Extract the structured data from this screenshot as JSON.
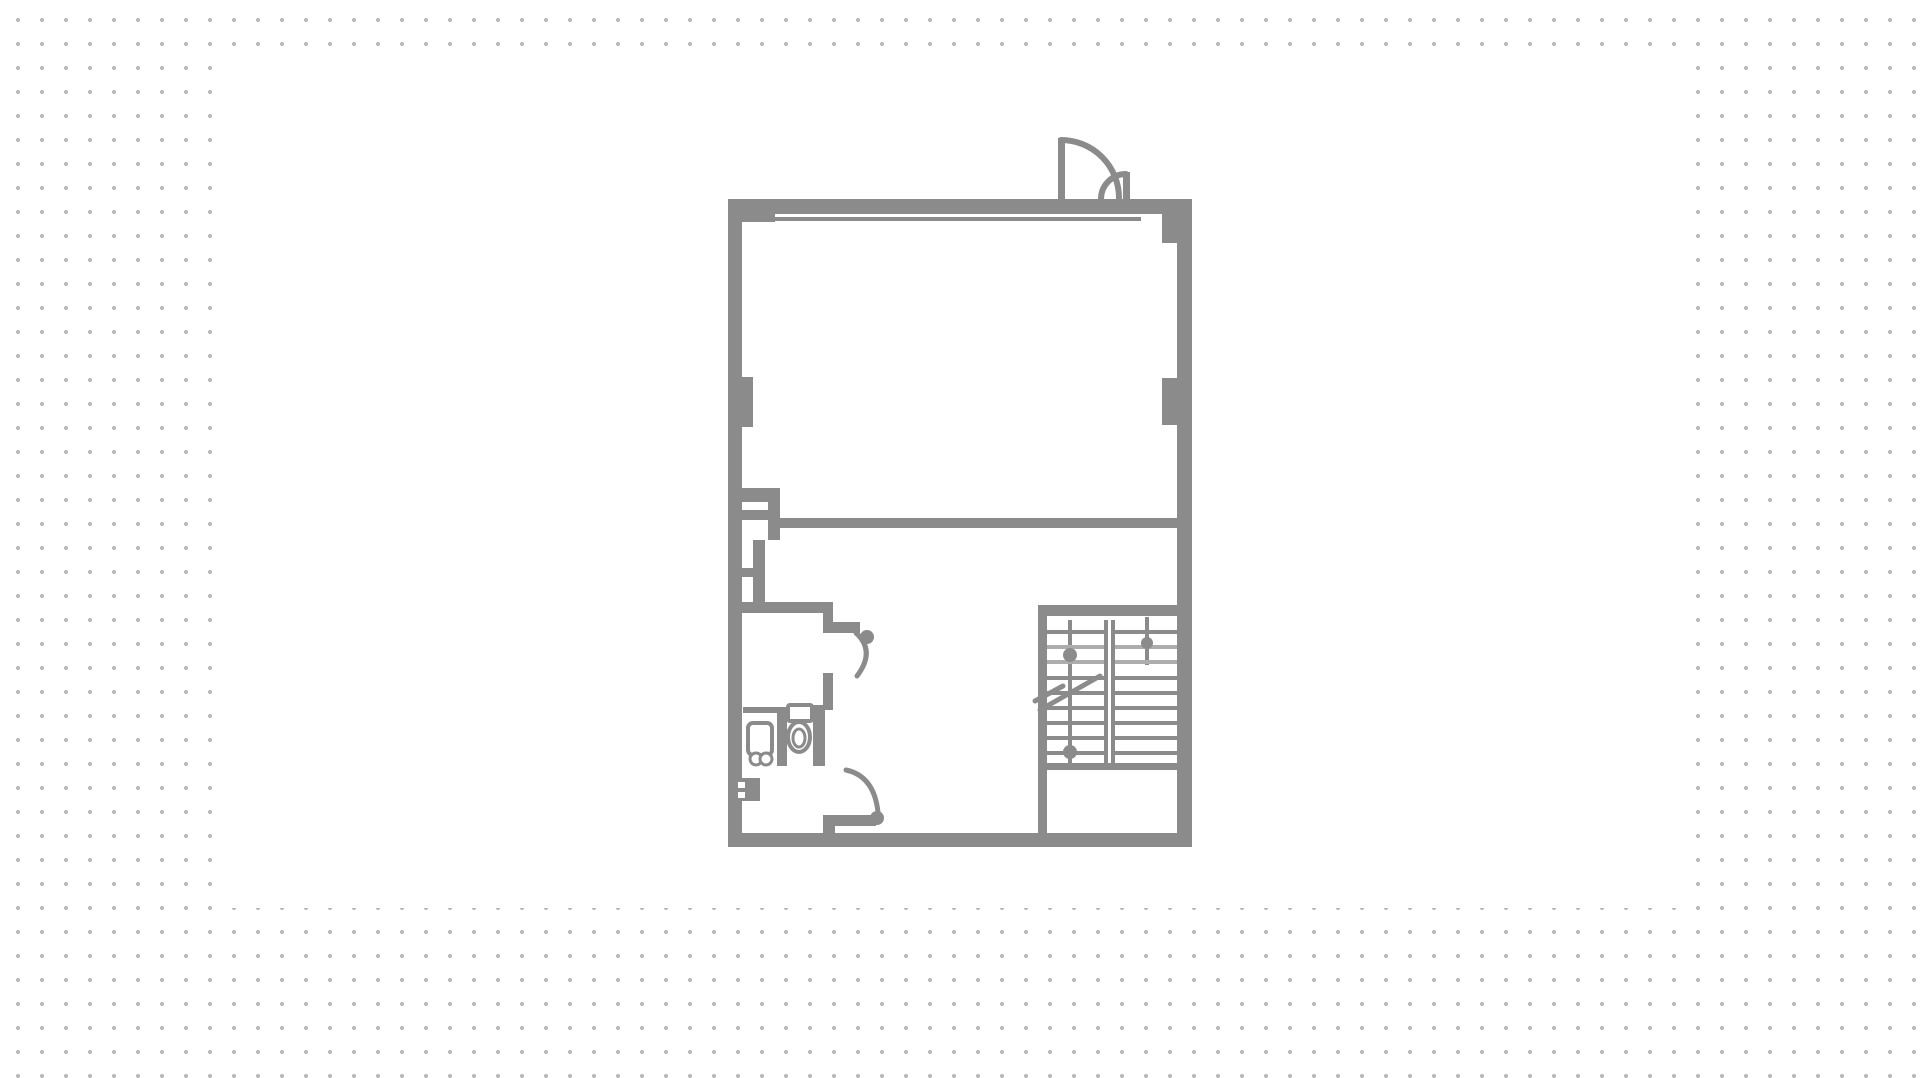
{
  "meta": {
    "type": "architectural-floor-plan",
    "description": "Gray line-drawing floor plan centered on a white panel over a dotted-grid background. Upper large empty room with storefront window wall and double entry door at top right; middle partition wall; lower zone with bathroom (washbasin and toilet), service ducts and shaft at left, two interior swing doors, and a double-flight staircase with direction arrows and break line at lower right.",
    "colors": {
      "background": "#ffffff",
      "grid_dot": "#b9b9b9",
      "wall": "#8b8b8b",
      "tread_light": "#adadad",
      "canvas": "#ffffff"
    }
  },
  "plan": {
    "canvas": {
      "x": 228,
      "y": 60,
      "w": 1462,
      "h": 848
    },
    "rects": [
      {
        "name": "wall-left",
        "x": 728,
        "y": 199,
        "w": 14,
        "h": 648
      },
      {
        "name": "wall-top",
        "x": 728,
        "y": 199,
        "w": 464,
        "h": 15
      },
      {
        "name": "wall-right",
        "x": 1177,
        "y": 199,
        "w": 15,
        "h": 648
      },
      {
        "name": "wall-right-head",
        "x": 1162,
        "y": 199,
        "w": 30,
        "h": 44
      },
      {
        "name": "wall-bottom",
        "x": 728,
        "y": 833,
        "w": 464,
        "h": 14
      },
      {
        "name": "window-end-block",
        "x": 742,
        "y": 213,
        "w": 33,
        "h": 9
      },
      {
        "name": "window-glazing-line",
        "x": 775,
        "y": 217,
        "w": 366,
        "h": 4
      },
      {
        "name": "pilaster-left",
        "x": 742,
        "y": 377,
        "w": 11,
        "h": 50
      },
      {
        "name": "pilaster-right",
        "x": 1162,
        "y": 378,
        "w": 15,
        "h": 47
      },
      {
        "name": "partition-mid-wall",
        "x": 780,
        "y": 518,
        "w": 397,
        "h": 10
      },
      {
        "name": "closet-branch-wall",
        "x": 742,
        "y": 488,
        "w": 38,
        "h": 14
      },
      {
        "name": "closet-right-wall",
        "x": 768,
        "y": 488,
        "w": 12,
        "h": 52
      },
      {
        "name": "closet-divider",
        "x": 742,
        "y": 510,
        "w": 26,
        "h": 10
      },
      {
        "name": "duct-wall",
        "x": 753,
        "y": 540,
        "w": 12,
        "h": 63
      },
      {
        "name": "duct-divider",
        "x": 742,
        "y": 568,
        "w": 23,
        "h": 9
      },
      {
        "name": "bathroom-top-wall",
        "x": 742,
        "y": 602,
        "w": 91,
        "h": 11
      },
      {
        "name": "upper-door-jamb",
        "x": 823,
        "y": 613,
        "w": 10,
        "h": 20
      },
      {
        "name": "upper-door-leaf",
        "x": 833,
        "y": 622,
        "w": 27,
        "h": 11
      },
      {
        "name": "wall-stub",
        "x": 823,
        "y": 673,
        "w": 10,
        "h": 37
      },
      {
        "name": "bath-cell-top-left",
        "x": 743,
        "y": 707,
        "w": 34,
        "h": 6
      },
      {
        "name": "bath-cell-top-right",
        "x": 787,
        "y": 707,
        "w": 26,
        "h": 6
      },
      {
        "name": "bath-divider-wall",
        "x": 777,
        "y": 707,
        "w": 10,
        "h": 59
      },
      {
        "name": "bath-right-wall",
        "x": 813,
        "y": 705,
        "w": 12,
        "h": 61
      },
      {
        "name": "shaft-box",
        "x": 738,
        "y": 778,
        "w": 22,
        "h": 23
      },
      {
        "name": "shaft-notch",
        "x": 738,
        "y": 782,
        "w": 7,
        "h": 6,
        "fill": "#ffffff"
      },
      {
        "name": "shaft-notch",
        "x": 738,
        "y": 792,
        "w": 7,
        "h": 6,
        "fill": "#ffffff"
      },
      {
        "name": "lower-door-jamb",
        "x": 823,
        "y": 815,
        "w": 12,
        "h": 18
      },
      {
        "name": "lower-door-leaf",
        "x": 828,
        "y": 815,
        "w": 48,
        "h": 11
      },
      {
        "name": "stair-left-wall",
        "x": 1038,
        "y": 605,
        "w": 9,
        "h": 228
      },
      {
        "name": "stair-top-edge",
        "x": 1038,
        "y": 605,
        "w": 139,
        "h": 11
      },
      {
        "name": "stair-bottom-edge",
        "x": 1047,
        "y": 763,
        "w": 130,
        "h": 7
      },
      {
        "name": "stair-center-divider",
        "x": 1104,
        "y": 620,
        "w": 4,
        "h": 150
      },
      {
        "name": "stair-center-divider",
        "x": 1111,
        "y": 620,
        "w": 4,
        "h": 150
      },
      {
        "name": "stair-direction-line",
        "x": 1068,
        "y": 620,
        "w": 4,
        "h": 145
      },
      {
        "name": "stair-direction-line",
        "x": 1145,
        "y": 617,
        "w": 4,
        "h": 48
      },
      {
        "name": "entry-door-leaf-large",
        "x": 1058,
        "y": 138,
        "w": 7,
        "h": 61
      },
      {
        "name": "entry-door-leaf-small",
        "x": 1123,
        "y": 172,
        "w": 7,
        "h": 27
      },
      {
        "name": "stair-tread",
        "x": 1047,
        "y": 630,
        "w": 57,
        "h": 4
      },
      {
        "name": "stair-tread",
        "x": 1047,
        "y": 645,
        "w": 57,
        "h": 4,
        "fill": "#adadad"
      },
      {
        "name": "stair-tread",
        "x": 1047,
        "y": 660,
        "w": 57,
        "h": 4,
        "fill": "#adadad"
      },
      {
        "name": "stair-tread",
        "x": 1047,
        "y": 676,
        "w": 57,
        "h": 4
      },
      {
        "name": "stair-tread",
        "x": 1047,
        "y": 691,
        "w": 57,
        "h": 4
      },
      {
        "name": "stair-tread",
        "x": 1047,
        "y": 706,
        "w": 57,
        "h": 4
      },
      {
        "name": "stair-tread",
        "x": 1047,
        "y": 721,
        "w": 57,
        "h": 4
      },
      {
        "name": "stair-tread",
        "x": 1047,
        "y": 736,
        "w": 57,
        "h": 4
      },
      {
        "name": "stair-tread",
        "x": 1047,
        "y": 751,
        "w": 57,
        "h": 4
      },
      {
        "name": "stair-tread",
        "x": 1115,
        "y": 630,
        "w": 62,
        "h": 4
      },
      {
        "name": "stair-tread",
        "x": 1115,
        "y": 645,
        "w": 62,
        "h": 4,
        "fill": "#adadad"
      },
      {
        "name": "stair-tread",
        "x": 1115,
        "y": 660,
        "w": 62,
        "h": 4,
        "fill": "#adadad"
      },
      {
        "name": "stair-tread",
        "x": 1115,
        "y": 676,
        "w": 62,
        "h": 4
      },
      {
        "name": "stair-tread",
        "x": 1115,
        "y": 691,
        "w": 62,
        "h": 4
      },
      {
        "name": "stair-tread",
        "x": 1115,
        "y": 706,
        "w": 62,
        "h": 4
      },
      {
        "name": "stair-tread",
        "x": 1115,
        "y": 721,
        "w": 62,
        "h": 4
      },
      {
        "name": "stair-tread",
        "x": 1115,
        "y": 736,
        "w": 62,
        "h": 4
      },
      {
        "name": "stair-tread",
        "x": 1115,
        "y": 751,
        "w": 62,
        "h": 4
      }
    ],
    "paths": [
      {
        "name": "entry-door-swing-large",
        "d": "M 1061 140 A 58 58 0 0 1 1119 198",
        "sw": 6
      },
      {
        "name": "entry-door-swing-small",
        "d": "M 1126 174 A 25 25 0 0 0 1101 199",
        "sw": 6
      },
      {
        "name": "upper-door-swing",
        "d": "M 856 633 Q 876 651 857 676",
        "sw": 5
      },
      {
        "name": "lower-door-swing",
        "d": "M 846 770 Q 874 776 878 812",
        "sw": 5
      },
      {
        "name": "stair-break-line",
        "d": "M 1040 710 L 1100 676",
        "sw": 5
      },
      {
        "name": "stair-break-line",
        "d": "M 1035 701 L 1063 686",
        "sw": 5
      }
    ],
    "stroked_rects": [
      {
        "name": "washbasin",
        "x": 748,
        "y": 723,
        "w": 24,
        "h": 32,
        "rx": 5,
        "sw": 4
      },
      {
        "name": "toilet-tank",
        "x": 788,
        "y": 705,
        "w": 24,
        "h": 16,
        "rx": 2,
        "sw": 4
      }
    ],
    "ellipses": [
      {
        "name": "toilet-bowl",
        "cx": 799,
        "cy": 737,
        "rx": 11,
        "ry": 15,
        "sw": 4
      },
      {
        "name": "toilet-bowl-inner",
        "cx": 799,
        "cy": 738,
        "rx": 6,
        "ry": 9,
        "sw": 3
      }
    ],
    "rings": [
      {
        "name": "washbasin-knob",
        "cx": 756,
        "cy": 759,
        "r": 6,
        "sw": 3
      },
      {
        "name": "washbasin-knob",
        "cx": 766,
        "cy": 759,
        "r": 6,
        "sw": 3
      }
    ],
    "dots": [
      {
        "name": "upper-door-hinge-dot",
        "cx": 867,
        "cy": 637,
        "r": 7
      },
      {
        "name": "lower-door-hinge-dot",
        "cx": 877,
        "cy": 818,
        "r": 7
      },
      {
        "name": "stair-arrow-dot",
        "cx": 1070,
        "cy": 655,
        "r": 7
      },
      {
        "name": "stair-arrow-dot",
        "cx": 1070,
        "cy": 752,
        "r": 7
      },
      {
        "name": "stair-arrow-dot",
        "cx": 1147,
        "cy": 643,
        "r": 6
      }
    ]
  }
}
